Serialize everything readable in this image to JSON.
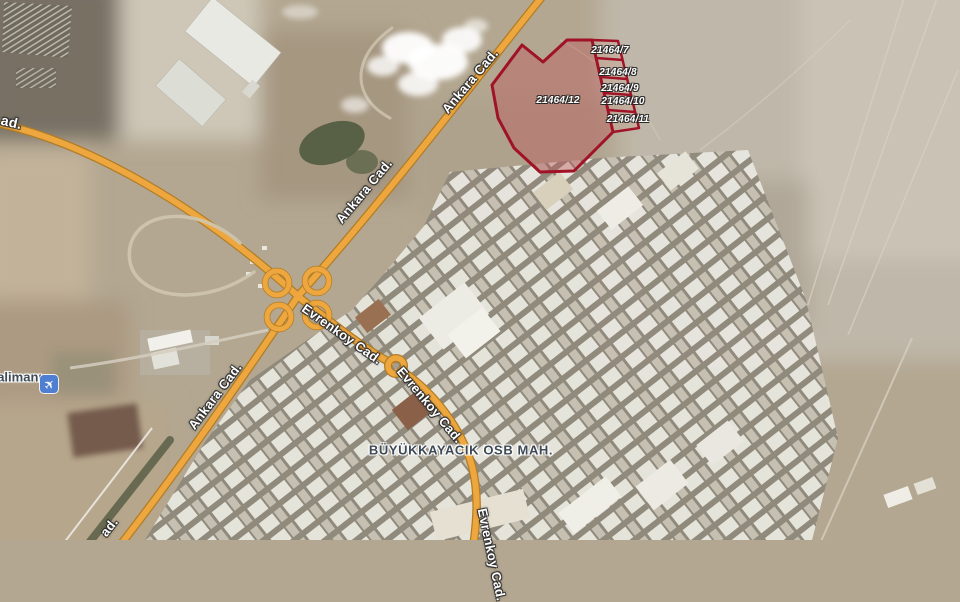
{
  "theme": {
    "road_fill": "#eea73e",
    "road_casing": "#b17c26",
    "parcel_outline": "#a01226",
    "parcel_fill": "rgba(190,80,85,0.38)",
    "label_dark": "#3d4954",
    "airport_icon_bg": "#4e7fd2"
  },
  "map": {
    "roads": {
      "ankara": {
        "label": "Ankara Cad."
      },
      "evrenkoy": {
        "label": "Evrenkoy Cad."
      },
      "cut_top_left": {
        "label": "ad."
      },
      "cut_bottom_left": {
        "label": "ad."
      }
    },
    "district": {
      "label": "BÜYÜKKAYACIK OSB MAH."
    },
    "airport": {
      "label": "alimanı",
      "icon": "airplane"
    },
    "parcels": {
      "items": [
        {
          "label": "21464/7"
        },
        {
          "label": "21464/8"
        },
        {
          "label": "21464/9"
        },
        {
          "label": "21464/10"
        },
        {
          "label": "21464/11"
        },
        {
          "label": "21464/12"
        }
      ]
    }
  }
}
